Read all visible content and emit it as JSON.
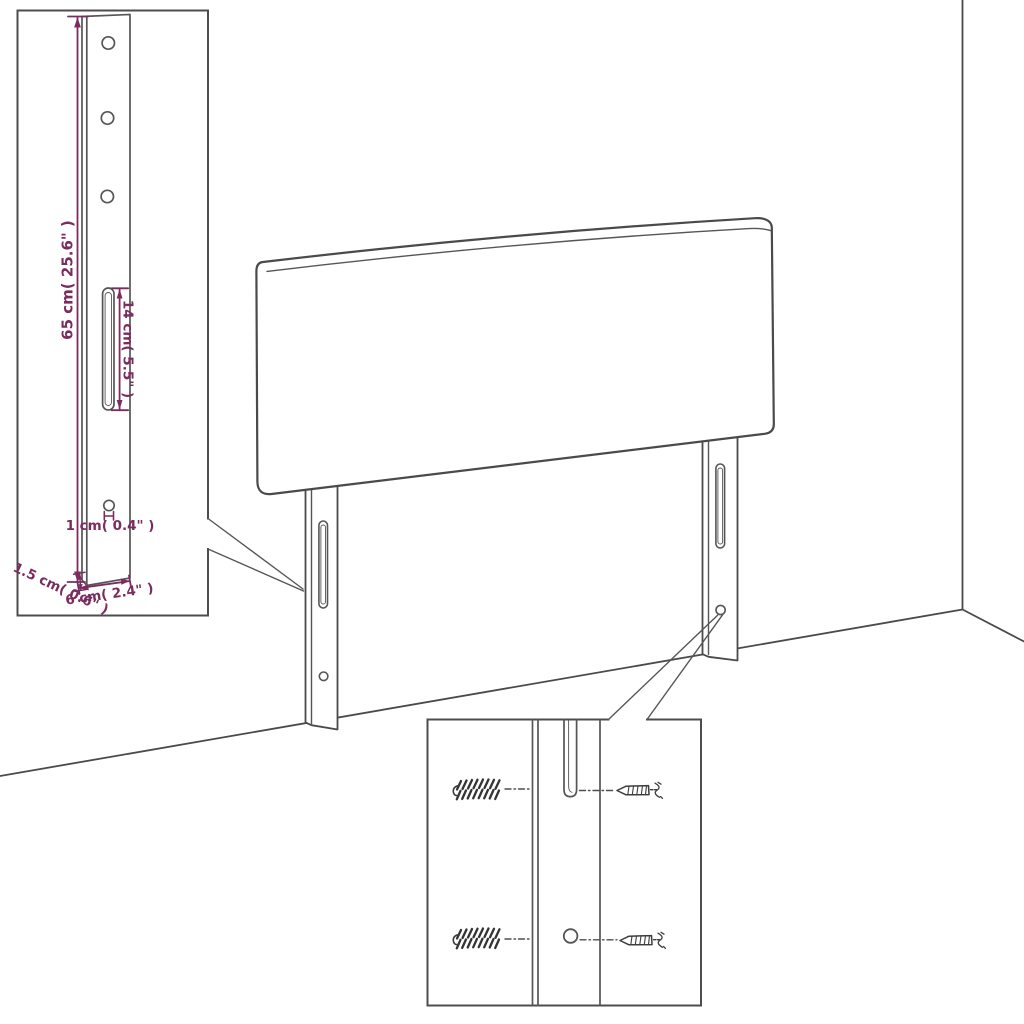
{
  "page": {
    "width": 1024,
    "height": 1024,
    "background": "#ffffff"
  },
  "diagram": {
    "kind": "furniture-dimension-diagram",
    "subject": "upholstered headboard with two slotted mounting legs, shown in a room corner",
    "colors": {
      "line": "#4a4a4a",
      "dimension": "#7b2c5f",
      "background": "#ffffff"
    },
    "leg_detail_callout": {
      "labels": {
        "leg_height": "65 cm( 25.6\" )",
        "slot_length": "14 cm( 5.5\" )",
        "hole_diameter": "1 cm( 0.4\" )",
        "leg_thickness": "1.5 cm( 0.6\" )",
        "leg_width": "6 cm( 2.4\" )"
      },
      "features": [
        "three-screw-holes",
        "long-slot",
        "lower-hole",
        "leg-side-face"
      ]
    },
    "screw_detail_callout": {
      "icons": {
        "wall_plug": "threaded-wall-plug-icon",
        "screw": "mounting-screw-icon",
        "alignment": "dashed-alignment-line"
      },
      "rows": [
        "plug-and-screw-aligned-to-slot-bottom",
        "plug-and-screw-aligned-to-round-hole"
      ]
    }
  }
}
